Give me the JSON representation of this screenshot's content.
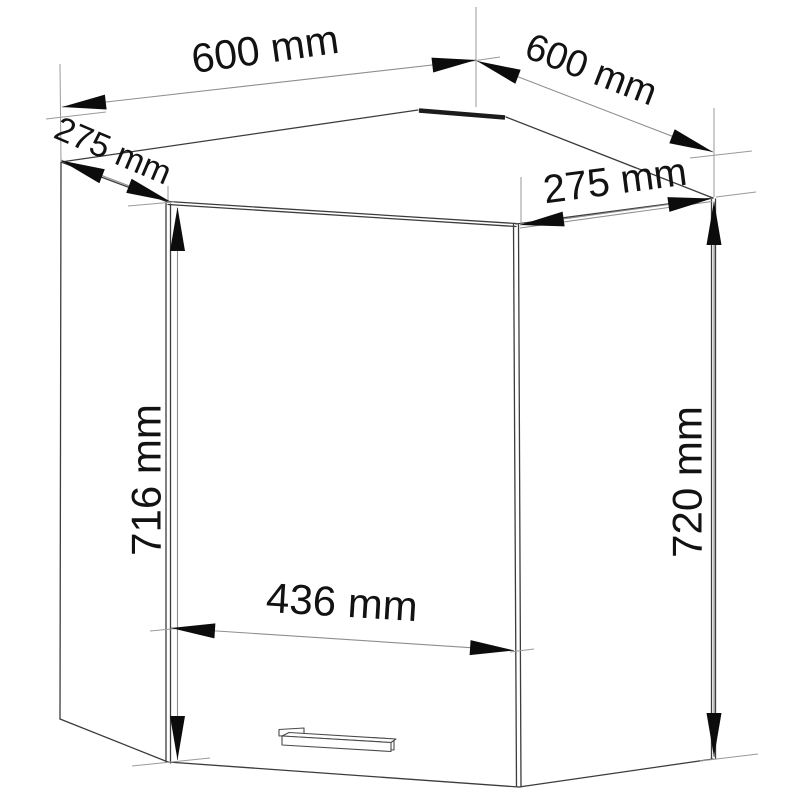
{
  "diagram": {
    "title": "corner wall cabinet technical drawing",
    "background": "#ffffff",
    "colors": {
      "edges": "#3c3c3c",
      "dimension_lines": "#8e8e8e",
      "arrowheads": "#0c0c0c",
      "text": "#121212"
    },
    "dimensions": {
      "top_width_left": {
        "value": 600,
        "unit": "mm",
        "label": "600 mm"
      },
      "top_width_right": {
        "value": 600,
        "unit": "mm",
        "label": "600 mm"
      },
      "side_depth_left": {
        "value": 275,
        "unit": "mm",
        "label": "275 mm"
      },
      "side_depth_right": {
        "value": 275,
        "unit": "mm",
        "label": "275 mm"
      },
      "front_height": {
        "value": 716,
        "unit": "mm",
        "label": "716 mm"
      },
      "back_height": {
        "value": 720,
        "unit": "mm",
        "label": "720 mm"
      },
      "door_width": {
        "value": 436,
        "unit": "mm",
        "label": "436 mm"
      }
    }
  }
}
